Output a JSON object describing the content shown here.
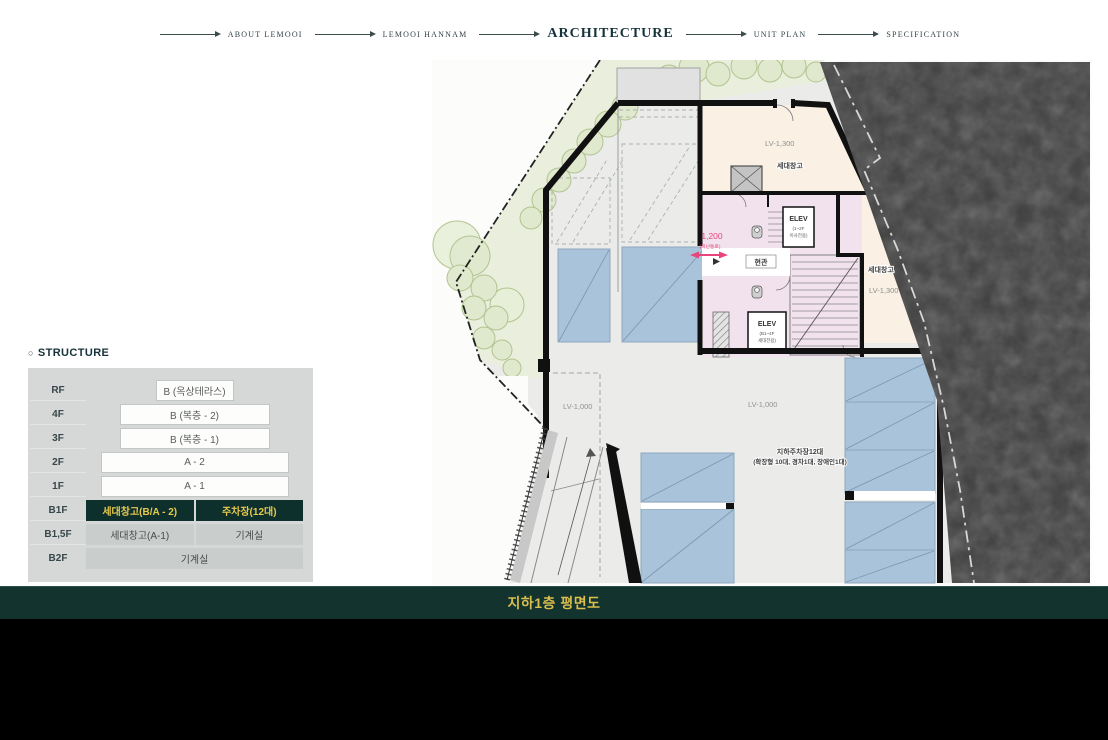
{
  "nav": {
    "items": [
      {
        "label": "ABOUT LEMOOI",
        "active": false
      },
      {
        "label": "LEMOOI HANNAM",
        "active": false
      },
      {
        "label": "ARCHITECTURE",
        "active": true
      },
      {
        "label": "UNIT PLAN",
        "active": false
      },
      {
        "label": "SPECIFICATION",
        "active": false
      }
    ]
  },
  "structure": {
    "bullet": "○",
    "heading": "STRUCTURE",
    "rows": [
      {
        "floor": "RF",
        "cells": [
          "B (옥상테라스)"
        ]
      },
      {
        "floor": "4F",
        "cells": [
          "B (복층 - 2)"
        ]
      },
      {
        "floor": "3F",
        "cells": [
          "B (복층 - 1)"
        ]
      },
      {
        "floor": "2F",
        "cells": [
          "A - 2"
        ]
      },
      {
        "floor": "1F",
        "cells": [
          "A - 1"
        ]
      },
      {
        "floor": "B1F",
        "cells": [
          "세대창고(B/A - 2)",
          "주차장(12대)"
        ]
      },
      {
        "floor": "B1,5F",
        "cells": [
          "세대창고(A-1)",
          "기계실"
        ]
      },
      {
        "floor": "B2F",
        "cells": [
          "기계실"
        ]
      }
    ]
  },
  "plan": {
    "labels": {
      "lv1300_a": "LV-1,300",
      "storage_a": "세대창고",
      "storage_b": "세대창고",
      "lv1300_b": "LV-1,300",
      "lv1000_a": "LV-1,000",
      "lv1000_b": "LV-1,000",
      "elev_top_1": "ELEV",
      "elev_top_2": "(1~2F",
      "elev_top_3": "이사전용)",
      "elev_bot_1": "ELEV",
      "elev_bot_2": "(B1~4F",
      "elev_bot_3": "세대전용)",
      "entrance": "현관",
      "dim_value": "1,200",
      "dim_note": "(피난통로)",
      "parking_note_1": "지하주차장12대",
      "parking_note_2": "(확장형 10대, 경차1대, 장애인1대)"
    }
  },
  "footer": {
    "title": "지하1층 평면도"
  },
  "colors": {
    "accent_dark_green": "#0d302c",
    "highlight_gold": "#e6c94f",
    "title_gold": "#d9bd4d",
    "dimension_pink": "#e8457a",
    "parking_blue": "#a9c3da",
    "room_cream": "#faf0e4",
    "core_pink": "#f2e2ed",
    "rock_dark": "#3e3e3e"
  }
}
